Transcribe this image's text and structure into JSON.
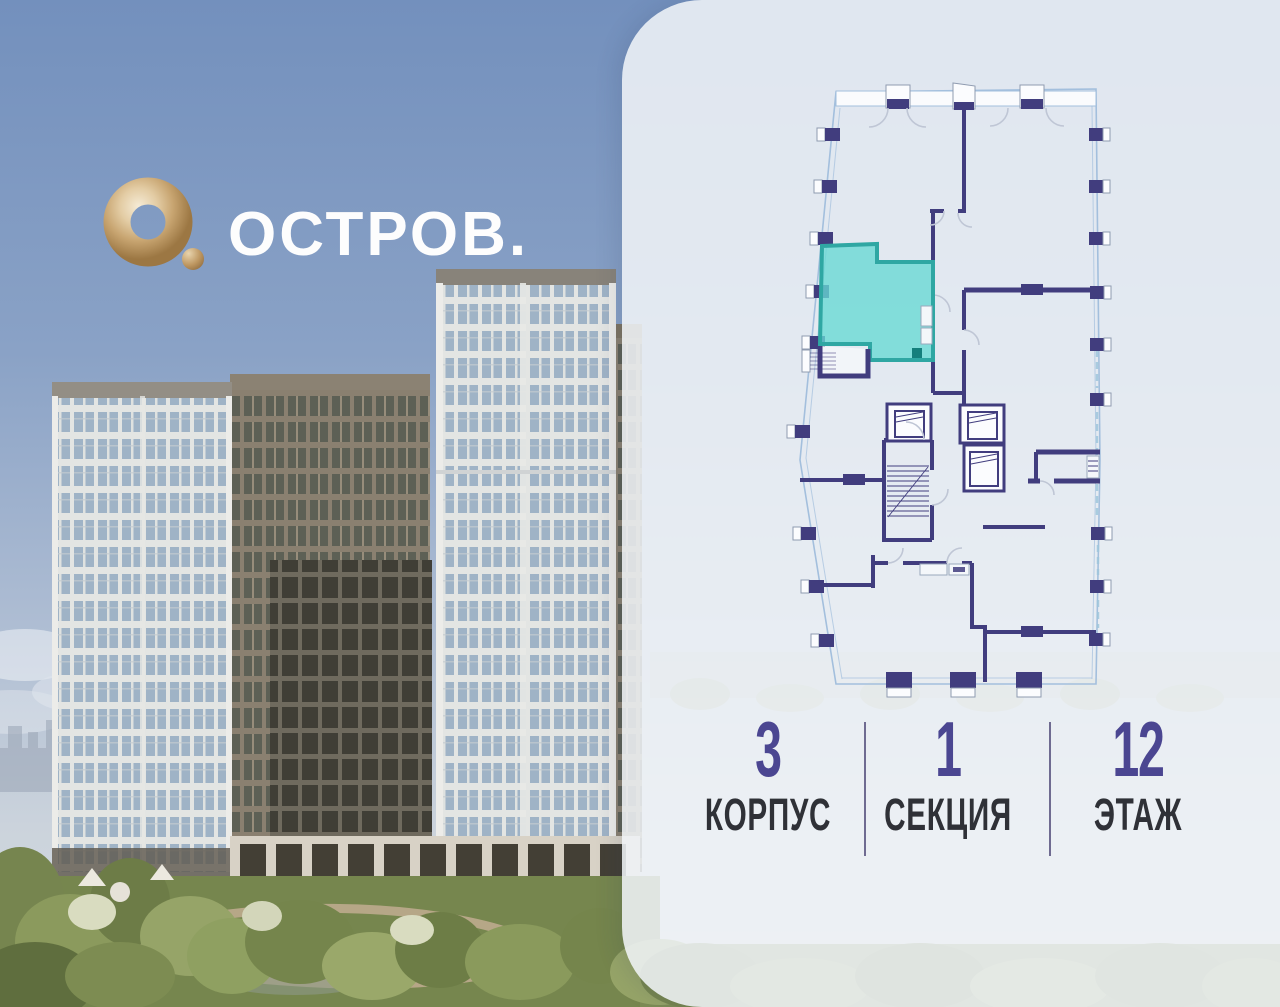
{
  "brand": {
    "logo_text": "ОСТРОВ.",
    "logo_mark": "gold-ring-icon"
  },
  "panel": {
    "content": "floor-plan"
  },
  "info": {
    "items": [
      {
        "value": "3",
        "label": "КОРПУС"
      },
      {
        "value": "1",
        "label": "СЕКЦИЯ"
      },
      {
        "value": "12",
        "label": "ЭТАЖ"
      }
    ]
  },
  "theme": {
    "accent_purple": "#4B4691",
    "label_dark": "#2F3137",
    "divider": "#59537F",
    "navy": "#413D7E",
    "teal_fill": "rgba(102,216,211,0.78)",
    "teal_stroke": "#2FA7A3",
    "outline_blue": "#A3BFDD",
    "arc_gray": "#BFC6D5",
    "panel_bg": "rgba(240,243,247,0.87)"
  }
}
